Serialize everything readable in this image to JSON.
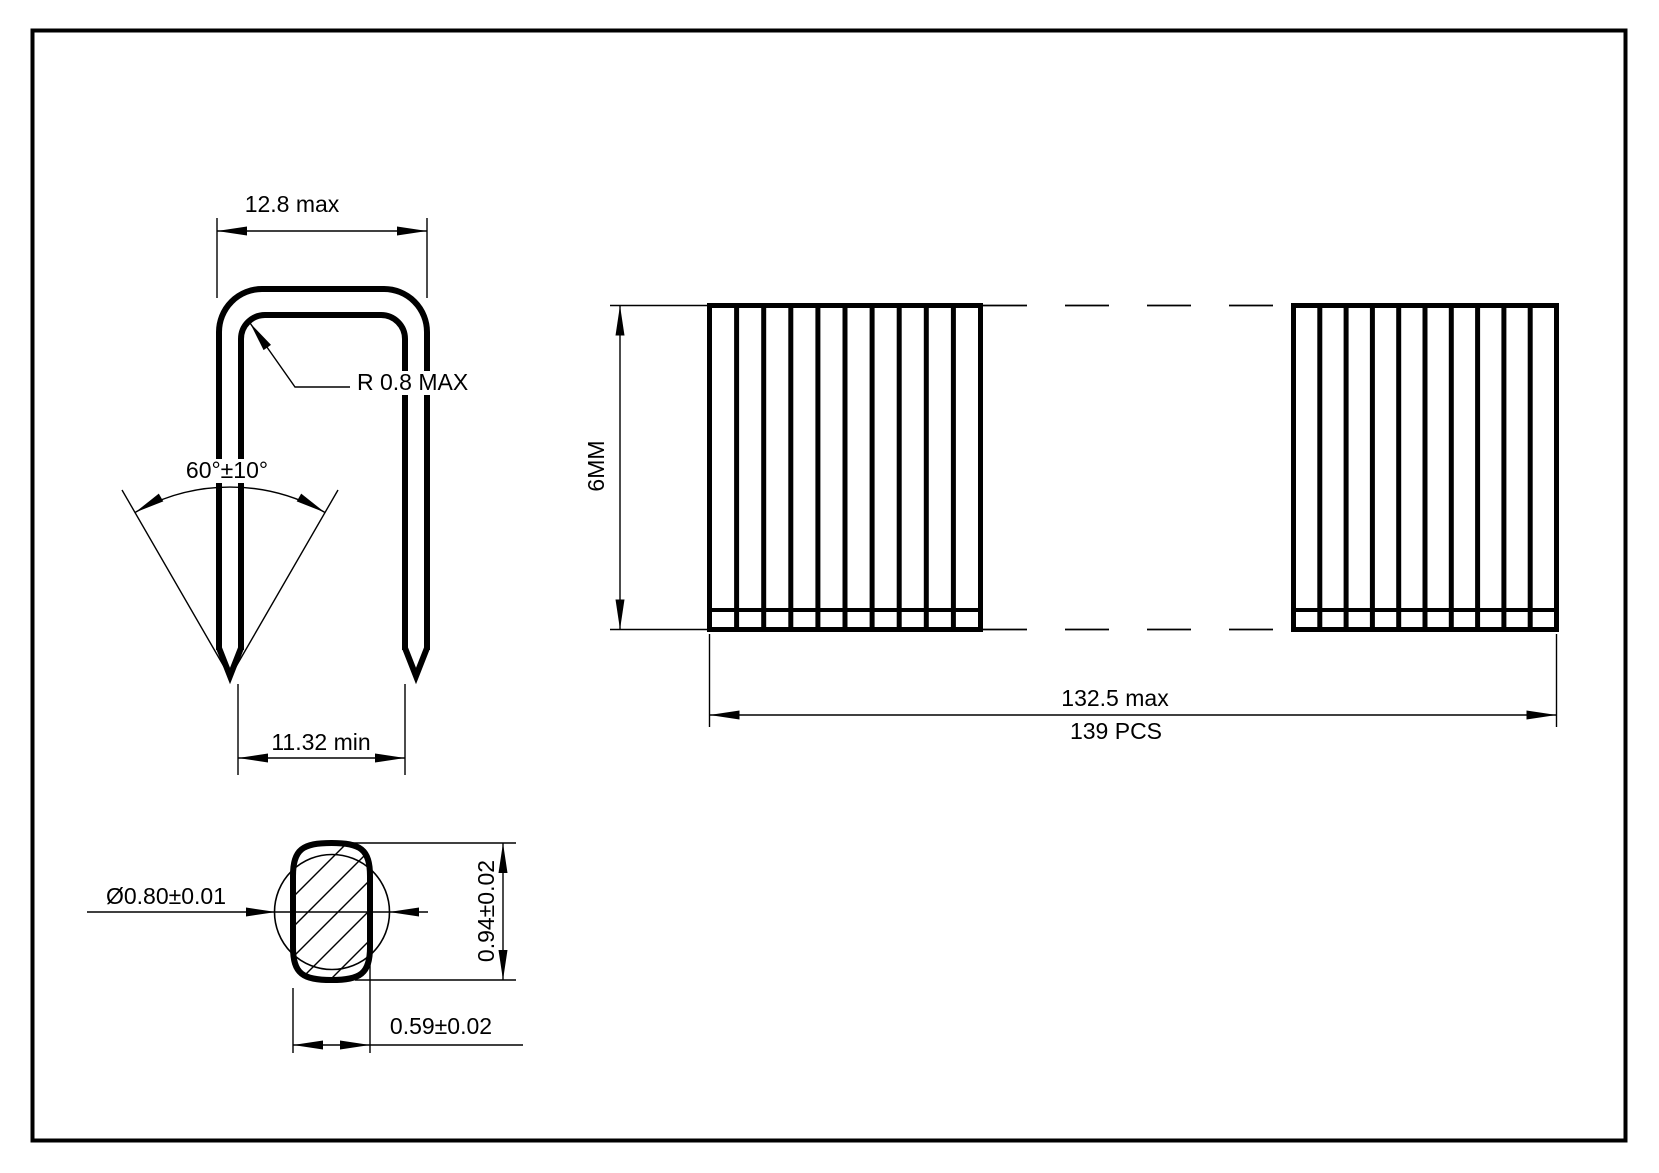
{
  "front_view": {
    "crown_width": "12.8 max",
    "corner_radius": "R 0.8 MAX",
    "point_angle": "60°±10°",
    "inner_width": "11.32 min"
  },
  "strip_view": {
    "leg_height": "6MM",
    "strip_length": "132.5 max",
    "piece_count": "139 PCS"
  },
  "wire_section_view": {
    "wire_diameter": "Ø0.80±0.01",
    "section_height": "0.94±0.02",
    "section_width": "0.59±0.02"
  },
  "colors": {
    "line": "#000000",
    "background": "#ffffff"
  }
}
